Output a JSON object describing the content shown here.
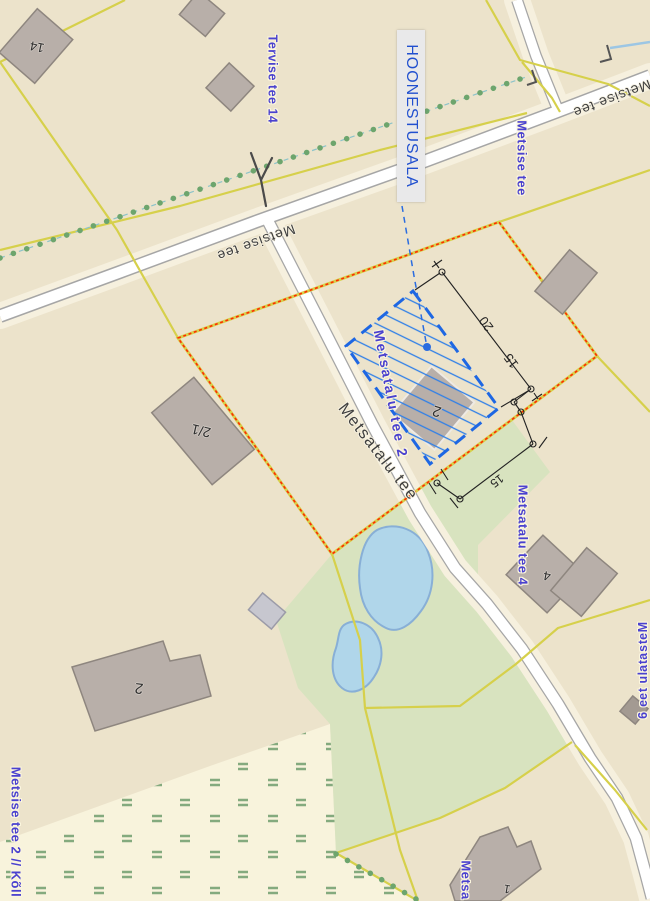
{
  "map": {
    "title": "Detail planning map extract",
    "annotation": {
      "building_area_label": "HOONESTUSALA"
    },
    "road_names": {
      "metsise_tee": "Metsise tee",
      "metsatalu_tee": "Metsatalu tee"
    },
    "address_labels": {
      "tervise_tee_14": "Tervise tee 14",
      "metsise_tee_blue": "Metsise tee",
      "metsatalu_tee_2": "Metsatalu tee 2",
      "metsatalu_tee_4": "Metsatalu tee 4",
      "metsatalu_tee_6": "Metsatalu tee 6",
      "metsise_tee_2_kolli": "Metsise tee 2 // Kõll",
      "metsa_partial": "Metsa"
    },
    "building_numbers": {
      "b14": "14",
      "b21": "2/1",
      "b2_center": "2",
      "b4": "4",
      "b2_large": "2",
      "b1": "1"
    },
    "dimensions_m": {
      "d20": "20",
      "d15a": "15",
      "d15b": "15"
    },
    "colors": {
      "background": "#ece3cb",
      "parcel_line_yellow": "#d6d04b",
      "selection_red": "#ff2b00",
      "building_area_blue": "#1e67e3",
      "leader_blue": "#2a6ce0",
      "label_blue": "#4a41cf",
      "road_label_black": "#3e3e3e",
      "road_fill": "#ffffff",
      "road_casing": "#a6a6a6",
      "road_halo": "#f6f0de",
      "green_area": "#d8e3bf",
      "wetland_fill": "#f8f3dc",
      "wetland_mark_green": "#84aa7e",
      "pond_fill": "#b0d6ea",
      "pond_stroke": "#88afd6",
      "building_fill": "#b8afa9",
      "building_stroke": "#8e867f",
      "hedge_dot_green": "#6da56d",
      "dim_black": "#222222"
    }
  }
}
